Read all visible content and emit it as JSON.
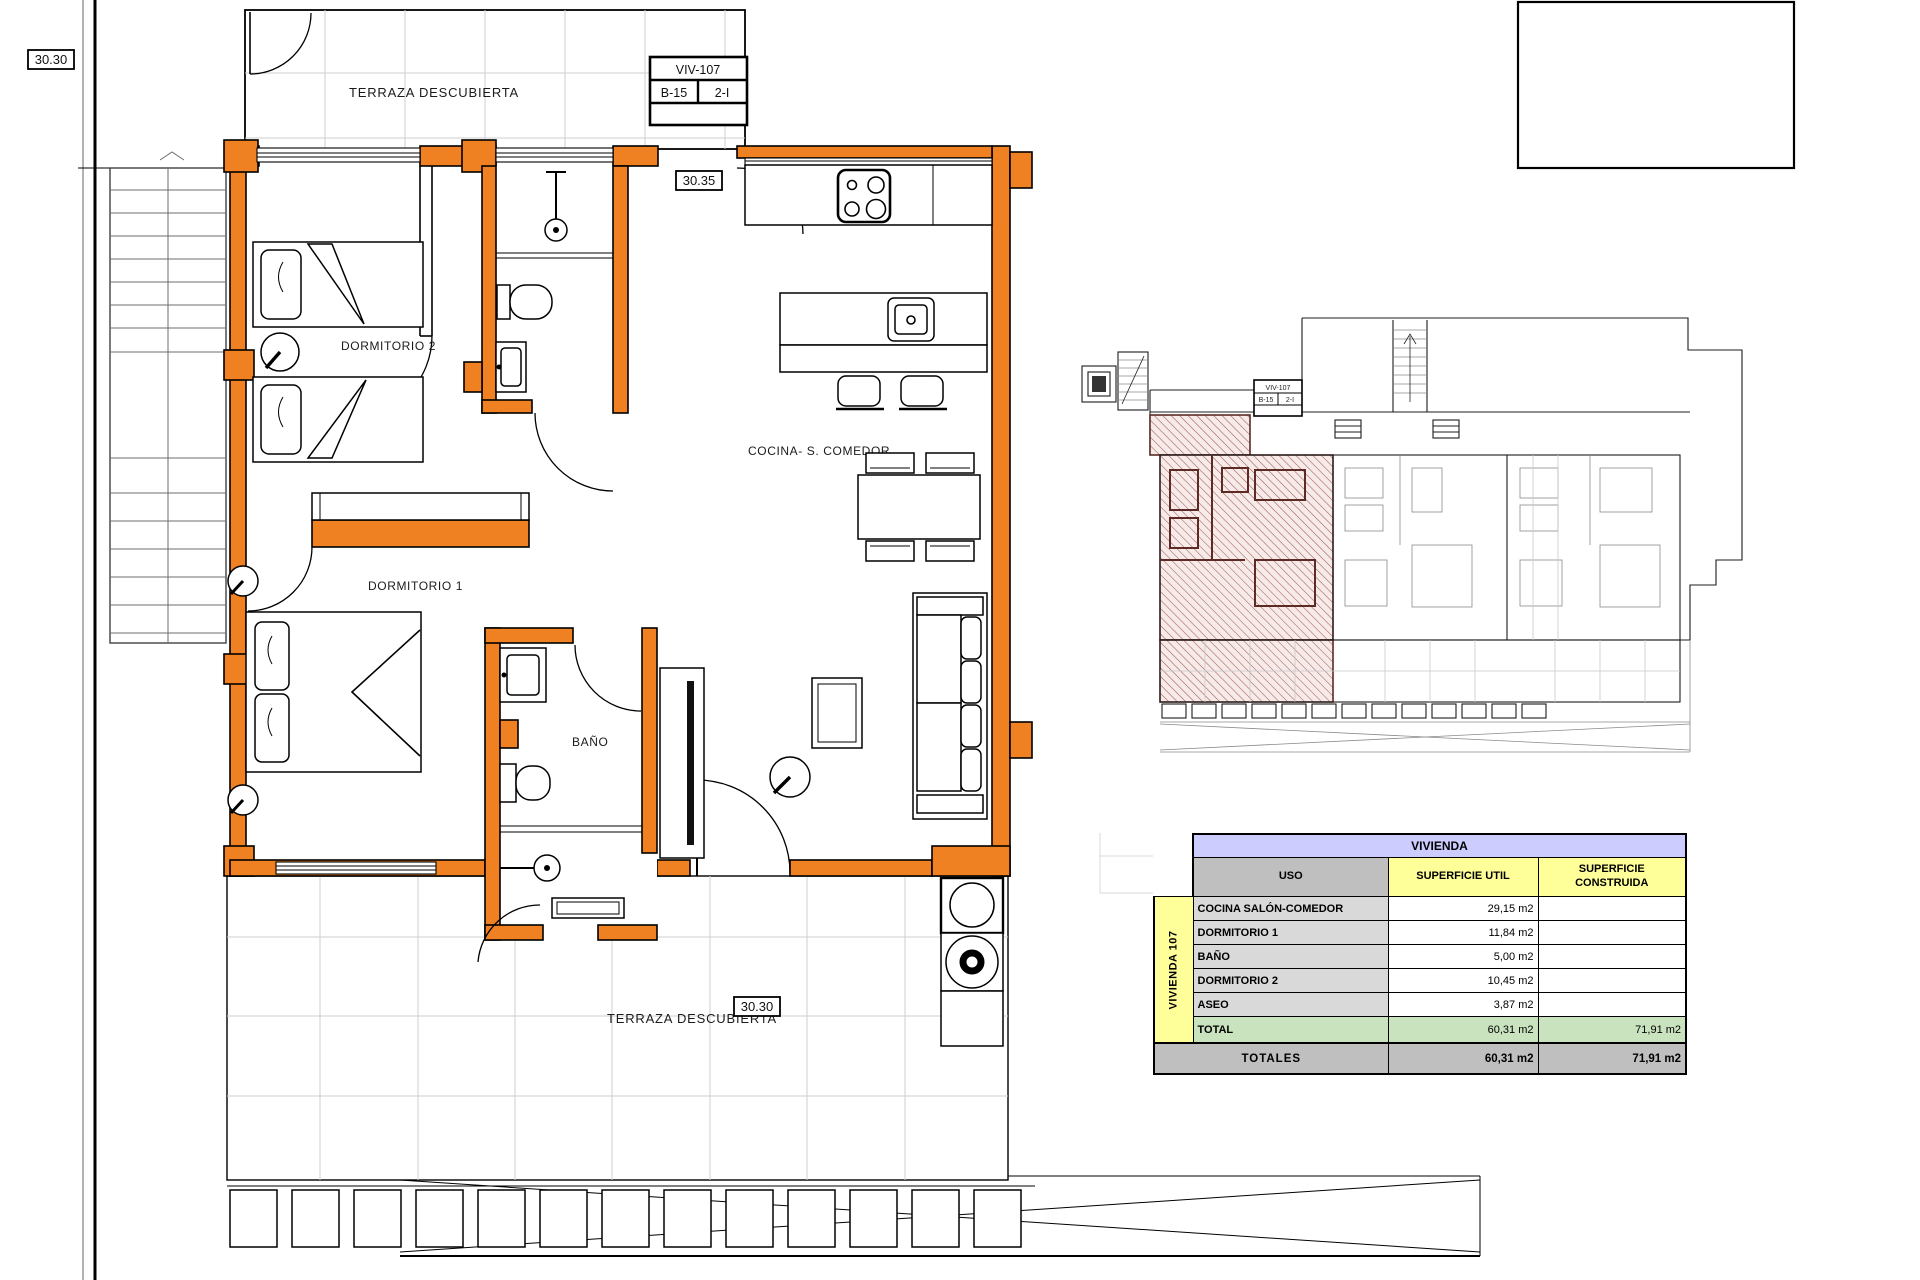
{
  "labels": {
    "terrace_top": "TERRAZA DESCUBIERTA",
    "terrace_bottom": "TERRAZA DESCUBIERTA",
    "bedroom2": "DORMITORIO 2",
    "bedroom1": "DORMITORIO 1",
    "bathroom": "BAÑO",
    "kitchen_living": "COCINA- S. COMEDOR",
    "dim_top_left": "30.30",
    "dim_entry": "30.35",
    "dim_bottom": "30.30"
  },
  "title_block": {
    "unit": "VIV-107",
    "block": "B-15",
    "tier": "2-I"
  },
  "overview_title_block": {
    "unit": "VIV-107",
    "block": "B-15",
    "tier": "2-I"
  },
  "area_table": {
    "title": "VIVIENDA",
    "group_label": "VIVIENDA 107",
    "headers": {
      "use": "USO",
      "useful": "SUPERFICIE UTIL",
      "built": "SUPERFICIE CONSTRUIDA"
    },
    "rows": [
      {
        "use": "COCINA SALÓN-COMEDOR",
        "useful": "29,15 m2",
        "built": ""
      },
      {
        "use": "DORMITORIO 1",
        "useful": "11,84 m2",
        "built": ""
      },
      {
        "use": "BAÑO",
        "useful": "5,00 m2",
        "built": ""
      },
      {
        "use": "DORMITORIO 2",
        "useful": "10,45 m2",
        "built": ""
      },
      {
        "use": "ASEO",
        "useful": "3,87 m2",
        "built": ""
      }
    ],
    "total": {
      "label": "TOTAL",
      "useful": "60,31 m2",
      "built": "71,91 m2"
    },
    "totals": {
      "label": "TOTALES",
      "useful": "60,31 m2",
      "built": "71,91 m2"
    }
  },
  "colors": {
    "wall_highlight": "#EF8122",
    "hatch_fill": "#F7EBEA",
    "hatch_line": "#A25B55",
    "hatch_wall": "#5E2A26",
    "table_title_blue": "#CCCCFF",
    "table_yellow": "#FFFF99",
    "table_gray": "#BFBFBF",
    "table_label_gray": "#D9D9D9",
    "table_total_green": "#C9E3BE",
    "tile_grid_gray": "#CFCFCF"
  }
}
